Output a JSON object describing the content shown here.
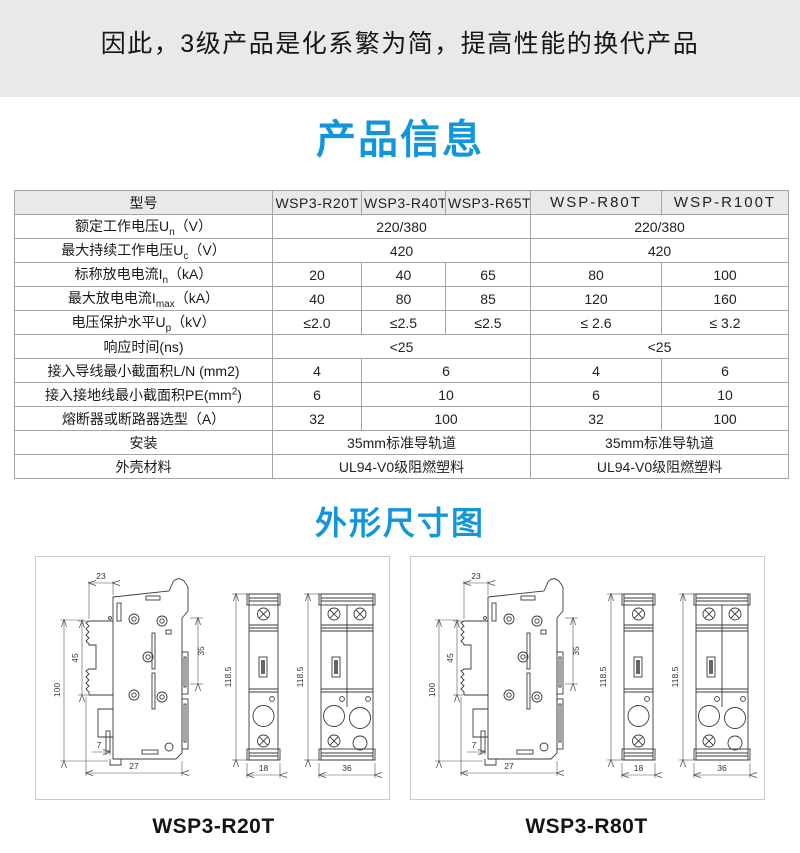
{
  "banner": {
    "text": "因此，3级产品是化系繁为简，提高性能的换代产品"
  },
  "titles": {
    "product_info": "产品信息",
    "dimensions": "外形尺寸图"
  },
  "table": {
    "header": {
      "col0": "型号",
      "models": [
        "WSP3-R20T",
        "WSP3-R40T",
        "WSP3-R65T",
        "WSP-R80T",
        "WSP-R100T"
      ]
    },
    "rows": [
      {
        "pre": "额定工作电压U",
        "sub": "n",
        "post": "（V）",
        "cells": [
          "220/380",
          "220/380"
        ]
      },
      {
        "pre": "最大持续工作电压U",
        "sub": "c",
        "post": "（V）",
        "cells": [
          "420",
          "420"
        ]
      },
      {
        "pre": "标称放电电流I",
        "sub": "n",
        "post": "（kA）",
        "cells": [
          "20",
          "40",
          "65",
          "80",
          "100"
        ]
      },
      {
        "pre": "最大放电电流I",
        "sub": "max",
        "post": "（kA）",
        "cells": [
          "40",
          "80",
          "85",
          "120",
          "160"
        ]
      },
      {
        "pre": "电压保护水平U",
        "sub": "p",
        "post": "（kV）",
        "cells": [
          "≤2.0",
          "≤2.5",
          "≤2.5",
          "≤ 2.6",
          "≤ 3.2"
        ]
      },
      {
        "pre": "响应时间(ns)",
        "cells": [
          "<25",
          "<25"
        ]
      },
      {
        "pre": "接入导线最小截面积L/N (mm2)",
        "cells": [
          "4",
          "6",
          "4",
          "6"
        ]
      },
      {
        "pre": "接入接地线最小截面积PE(mm",
        "sup": "2",
        "post": ")",
        "cells": [
          "6",
          "10",
          "6",
          "10"
        ]
      },
      {
        "pre": "熔断器或断路器选型（A）",
        "cells": [
          "32",
          "100",
          "32",
          "100"
        ]
      },
      {
        "pre": "安装",
        "cells": [
          "35mm标准导轨道",
          "35mm标准导轨道"
        ]
      },
      {
        "pre": "外壳材料",
        "cells": [
          "UL94-V0级阻燃塑料",
          "UL94-V0级阻燃塑料"
        ]
      }
    ]
  },
  "drawings": {
    "dims": {
      "top_width": "23",
      "left_height": "45",
      "total_height": "100",
      "right_height": "35",
      "bottom_notch": "7",
      "bottom_width": "27",
      "module_height": "118.5",
      "single_width": "18",
      "double_width": "36"
    },
    "panels": [
      {
        "label": "WSP3-R20T"
      },
      {
        "label": "WSP3-R80T"
      }
    ]
  },
  "colors": {
    "accent_blue": "#1296db",
    "banner_bg": "#e9e9e9",
    "table_border": "#a5a5a5"
  }
}
